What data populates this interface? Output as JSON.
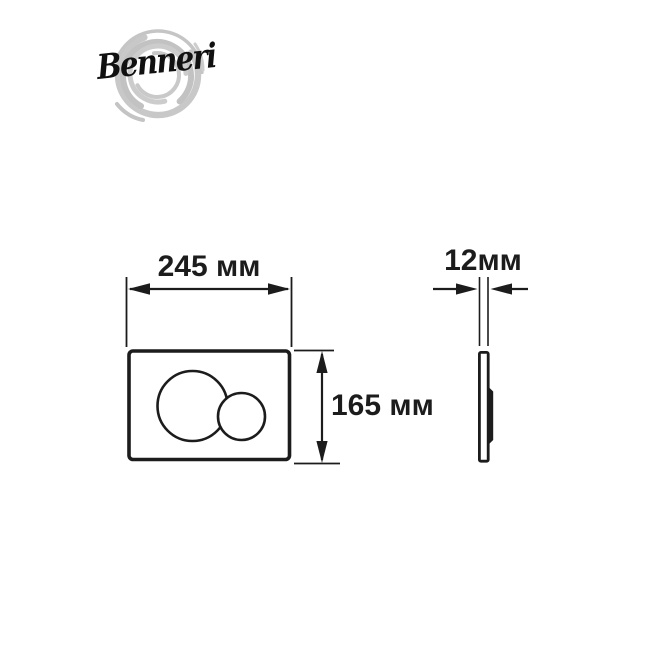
{
  "brand": {
    "logo_text": "Benneri"
  },
  "drawing": {
    "type": "technical-dimension-diagram",
    "product": "flush-plate-with-two-round-buttons",
    "front_view": {
      "width_label": "245 мм",
      "height_label": "165 мм"
    },
    "side_view": {
      "thickness_label": "12мм"
    },
    "colors": {
      "background": "#ffffff",
      "line": "#1c1c1c",
      "logo_text": "#111111",
      "logo_swirl": "#c6c6c6"
    }
  }
}
